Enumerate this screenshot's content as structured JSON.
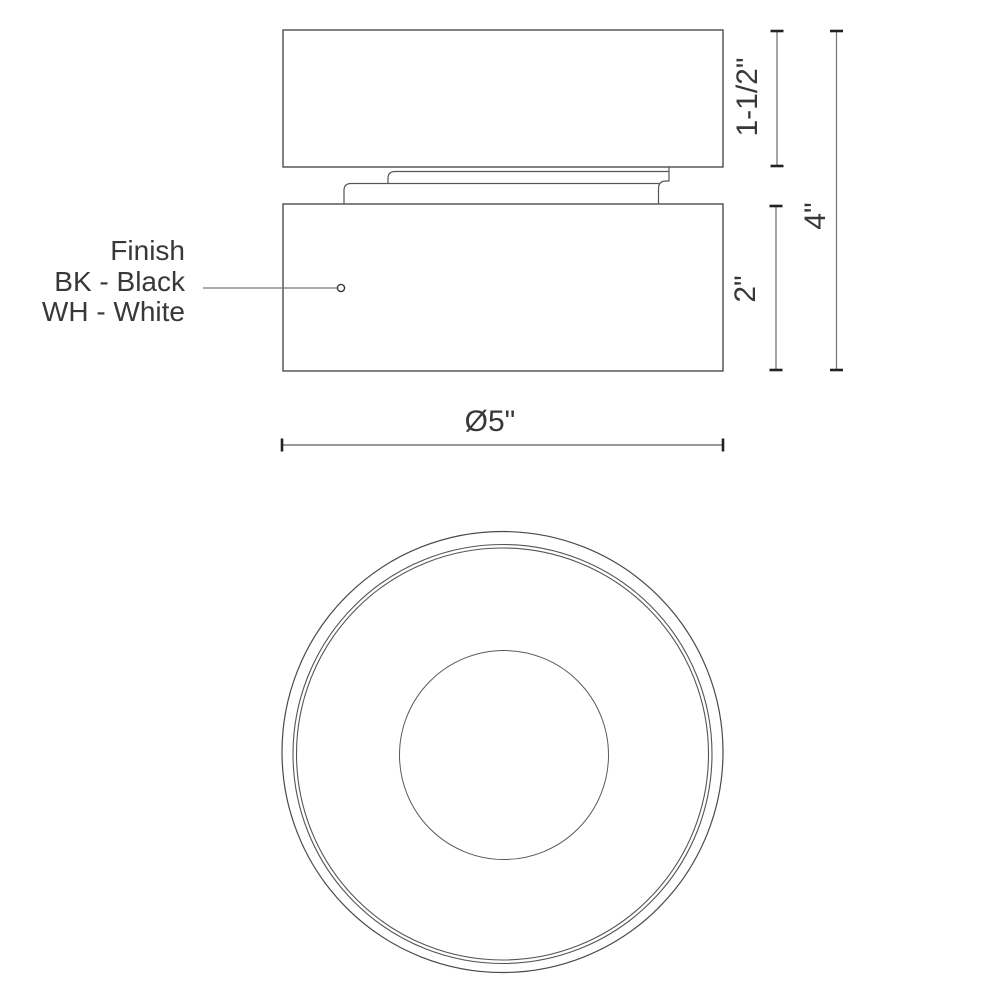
{
  "drawing": {
    "finish_note": {
      "title": "Finish",
      "option_black": "BK - Black",
      "option_white": "WH - White"
    },
    "dimensions": {
      "upper_section_height": "1-1/2\"",
      "lower_section_height": "2\"",
      "overall_height": "4\"",
      "diameter": "Ø5\""
    },
    "colors": {
      "background": "#ffffff",
      "outline": "#4d4d4d",
      "dimension_line": "#6a6a6a",
      "tick": "#222222",
      "text": "#383838"
    }
  }
}
